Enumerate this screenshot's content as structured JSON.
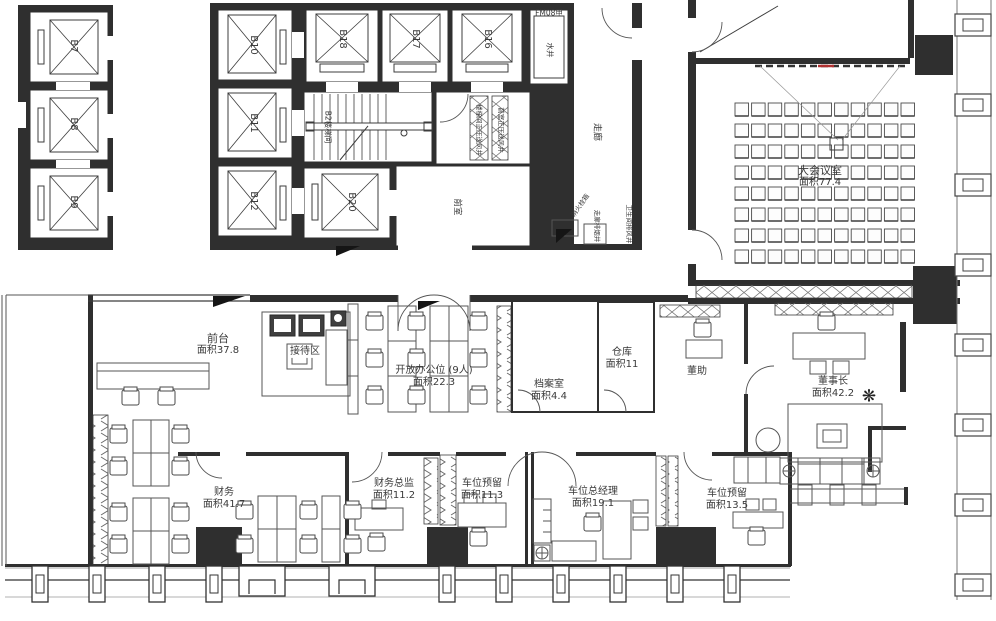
{
  "rooms": [
    {
      "name": "大会议室",
      "area": "面积77.4"
    },
    {
      "name": "前台",
      "area": "面积37.8"
    },
    {
      "name": "接待区"
    },
    {
      "name": "开放办公位 (9人)",
      "area": "面积22.3"
    },
    {
      "name": "档案室",
      "area": "面积4.4"
    },
    {
      "name": "仓库",
      "area": "面积11"
    },
    {
      "name": "董助"
    },
    {
      "name": "董事长",
      "area": "面积42.2"
    },
    {
      "name": "财务",
      "area": "面积41.7"
    },
    {
      "name": "财务总监",
      "area": "面积11.2"
    },
    {
      "name": "车位预留",
      "area": "面积11.3"
    },
    {
      "name": "车位总经理",
      "area": "面积19.1"
    },
    {
      "name": "车位预留",
      "area": "面积13.5"
    }
  ],
  "elevators": {
    "bank_left": [
      "B7",
      "B8",
      "B9"
    ],
    "core_left": [
      "B10",
      "B11",
      "B12"
    ],
    "core_top": [
      "B18",
      "B17",
      "B16"
    ],
    "core_lower": "B20"
  },
  "core": {
    "stairwell": "B2楼梯间",
    "fire_door": "FM08甲",
    "water_shaft": "水井",
    "corridor": "走廊",
    "anteroom": "前室",
    "pressure_shaft_stair": "楼梯间正压送风井",
    "pressure_shaft_lobby": "前室正压送风井",
    "fire_hydrant": "消火栓箱",
    "smoke_exhaust": "走廊排烟井",
    "toilet_exhaust": "卫生间排风井"
  },
  "icons": {
    "plant": "❋"
  },
  "colors": {
    "wall": "#2f2f2f",
    "line": "#3c3c3c",
    "furniture": "#555555",
    "screen_mark": "#b03030"
  }
}
